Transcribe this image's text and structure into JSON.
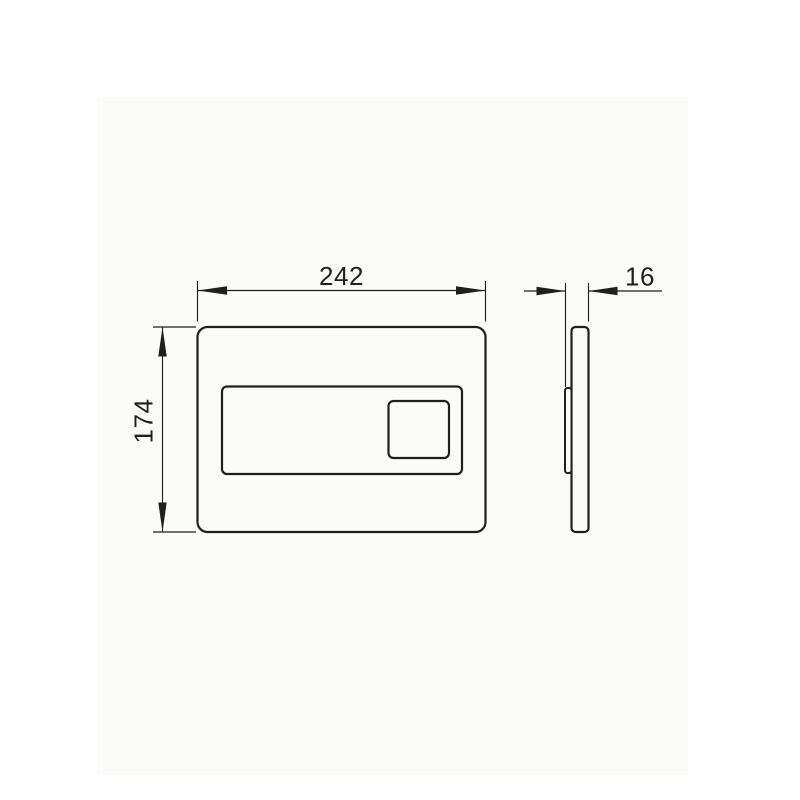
{
  "page": {
    "background_color": "#ffffff",
    "panel_tint": "#fbfcf9",
    "line_color": "#1f1f1f"
  },
  "drawing": {
    "type": "technical-dimension-drawing",
    "views": {
      "front": {
        "name": "flush-plate-front-view",
        "width_dimension": "242",
        "height_dimension": "174"
      },
      "side": {
        "name": "flush-plate-side-profile",
        "thickness_dimension": "16"
      }
    }
  }
}
